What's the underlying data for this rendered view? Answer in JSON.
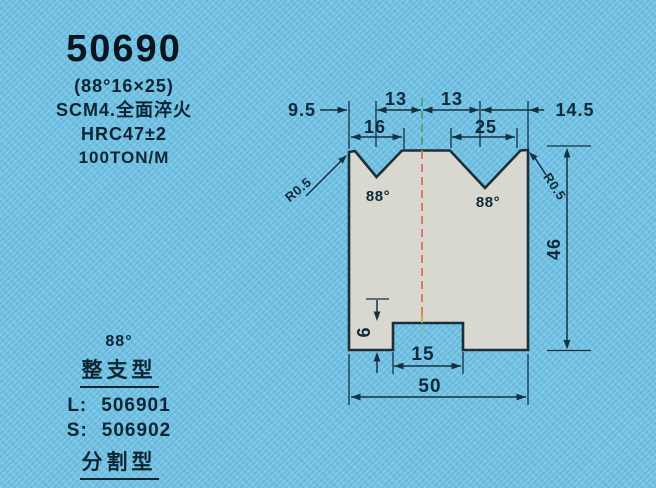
{
  "page": {
    "background_color": "#6fc2e5"
  },
  "spec_block": {
    "part_number": "50690",
    "angle_size": "(88°16×25)",
    "material": "SCM4.全面淬火",
    "hardness": "HRC47±2",
    "tonnage": "100TON/M"
  },
  "order_block": {
    "angle": "88°",
    "solid_type_label": "整支型",
    "solid_items": [
      {
        "prefix": "L:",
        "code": "506901"
      },
      {
        "prefix": "S:",
        "code": "506902"
      }
    ],
    "split_type_label": "分割型",
    "split_items": [
      {
        "prefix": "L:",
        "code": "506801"
      }
    ]
  },
  "drawing": {
    "type": "double-V press brake die cross-section",
    "dim_left_offset": "9.5",
    "dim_pitch_left": "13",
    "dim_pitch_right": "13",
    "dim_right_offset": "14.5",
    "dim_v_width_left": "16",
    "dim_v_width_right": "25",
    "dim_body_height": "46",
    "dim_slot_depth": "6",
    "dim_slot_width": "15",
    "dim_body_width": "50",
    "angle_label_left": "88°",
    "angle_label_right": "88°",
    "radius_label_left": "R0.5",
    "radius_label_right": "R0.5",
    "colors": {
      "body_fill": "#d8d7d0",
      "outline": "#1c2f38",
      "dimension_lines": "#14313f",
      "centerline_red": "#d4704f",
      "centerline_green": "#44a368",
      "centerline_yellow": "#a8ad52"
    }
  }
}
